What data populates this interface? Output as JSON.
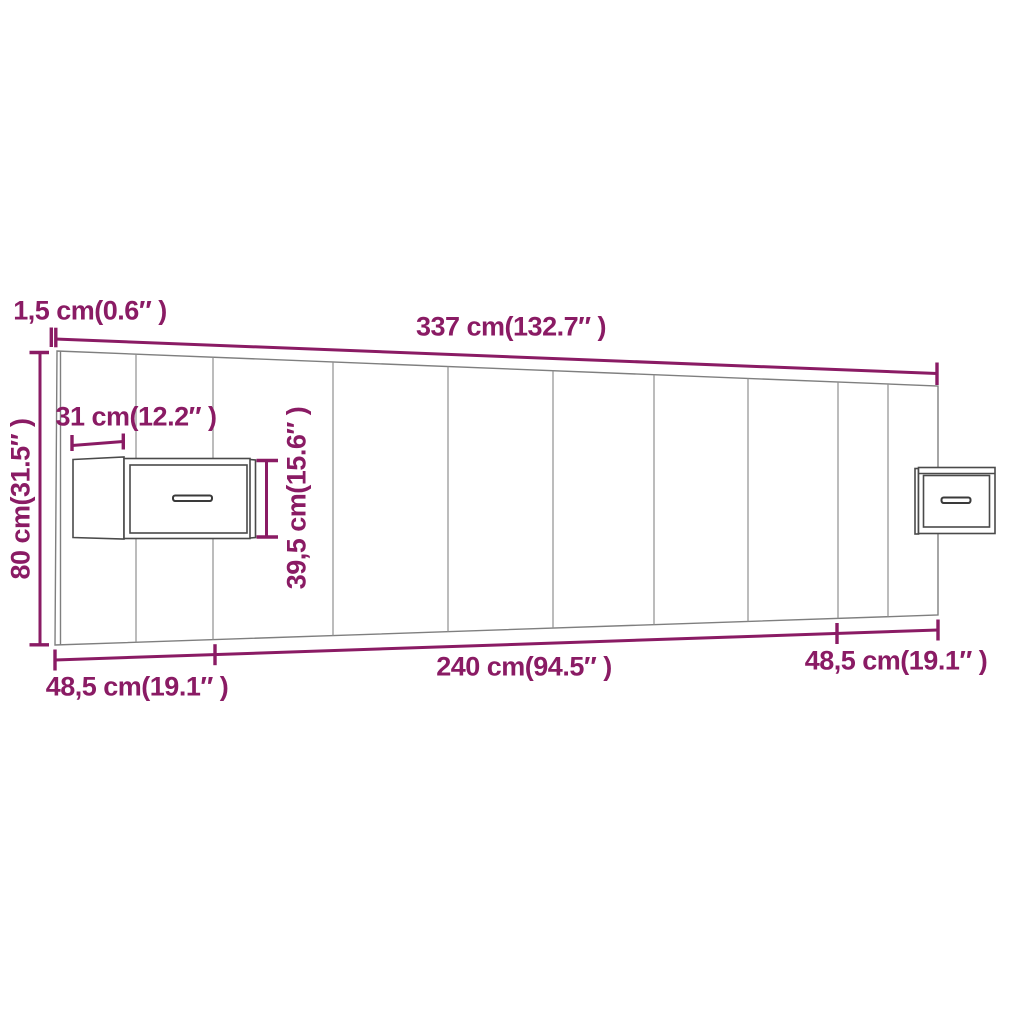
{
  "dims": {
    "thickness": {
      "label": "1,5 cm(0.6″ )",
      "cm": "1,5",
      "inch": "0.6"
    },
    "total_width": {
      "label": "337 cm(132.7″ )",
      "cm": "337",
      "inch": "132.7"
    },
    "cabinet_width": {
      "label": "31 cm(12.2″ )",
      "cm": "31",
      "inch": "12.2"
    },
    "cabinet_height": {
      "label": "39,5 cm(15.6″ )",
      "cm": "39,5",
      "inch": "15.6"
    },
    "headboard_height": {
      "label": "80 cm(31.5″ )",
      "cm": "80",
      "inch": "31.5"
    },
    "left_section": {
      "label": "48,5 cm(19.1″ )",
      "cm": "48,5",
      "inch": "19.1"
    },
    "middle_section": {
      "label": "240 cm(94.5″ )",
      "cm": "240",
      "inch": "94.5"
    },
    "right_section": {
      "label": "48,5 cm(19.1″ )",
      "cm": "48,5",
      "inch": "19.1"
    }
  },
  "colors": {
    "dimension_accent": "#8a1b64",
    "outline_gray": "#7f7f7f",
    "seam_gray": "#8f8f8f",
    "cabinet_gray": "#4a4a4a",
    "background": "#ffffff"
  }
}
